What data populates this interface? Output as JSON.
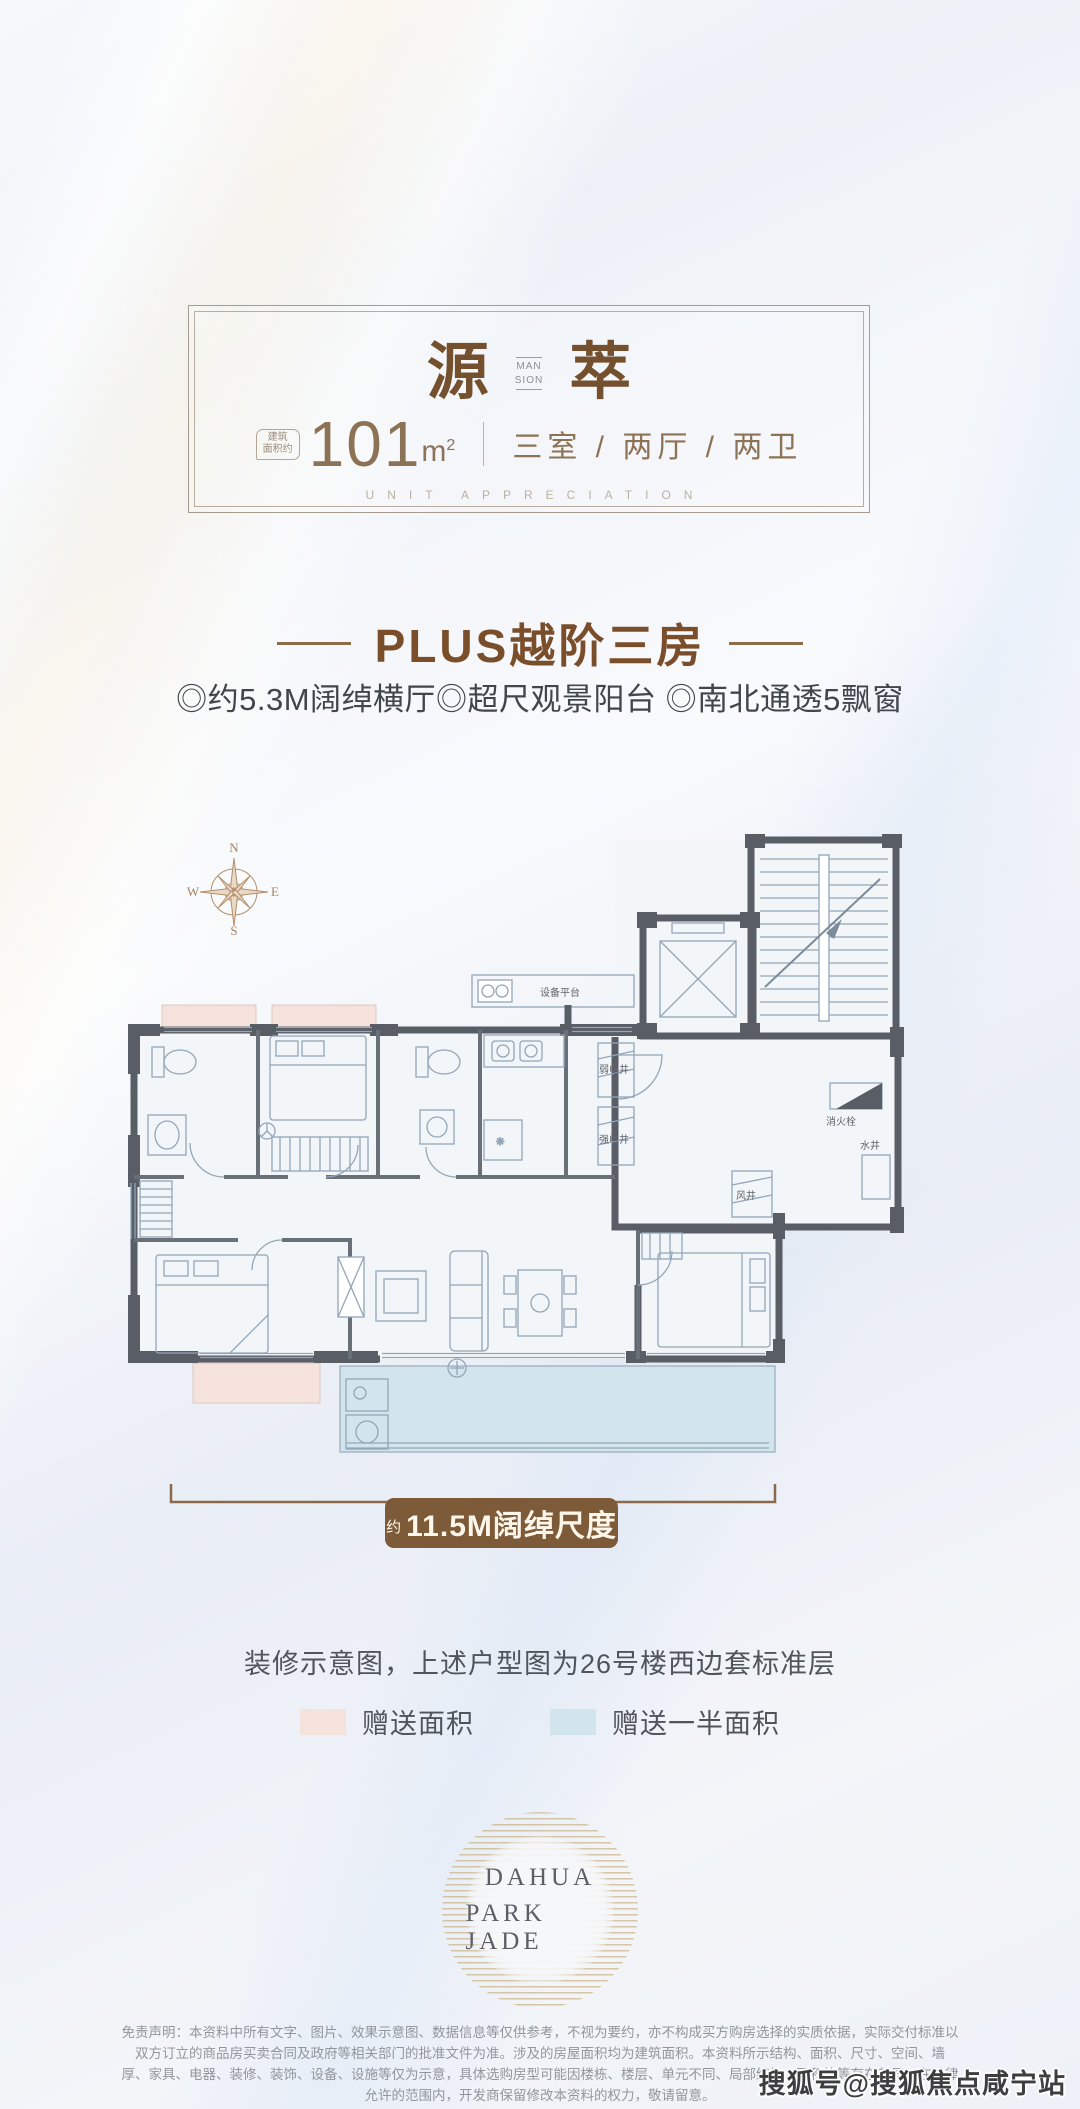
{
  "header_card": {
    "brand_first": "源",
    "brand_second": "萃",
    "brand_mid_top": "MAN",
    "brand_mid_bottom": "SION",
    "area_note_line1": "建筑",
    "area_note_line2": "面积约",
    "area_value": "101",
    "area_unit_base": "m",
    "area_unit_sup": "2",
    "rooms": "三室 / 两厅 / 两卫",
    "tagline": "UNIT APPRECIATION"
  },
  "headline": {
    "title": "PLUS越阶三房",
    "features": "◎约5.3M阔绰横厅◎超尺观景阳台 ◎南北通透5飘窗"
  },
  "compass": {
    "north": "N",
    "south": "S",
    "east": "E",
    "west": "W"
  },
  "floorplan": {
    "labels": {
      "equipment_platform": "设备平台",
      "weak_electric_shaft": "弱电井",
      "strong_electric_shaft": "强电井",
      "fire_hydrant": "消火栓",
      "water_shaft": "水井",
      "air_shaft": "风井"
    },
    "colors": {
      "wall": "#585d66",
      "furniture_line": "#92a6b8",
      "gift_area": "#f6e2dd",
      "half_gift_area": "#d3e5ec"
    }
  },
  "dimension": {
    "prefix": "约",
    "label": "11.5M阔绰尺度",
    "badge_color": "#7d5a38"
  },
  "caption": "装修示意图，上述户型图为26号楼西边套标准层",
  "legend": {
    "items": [
      {
        "label": "赠送面积",
        "color": "#f6e2dd"
      },
      {
        "label": "赠送一半面积",
        "color": "#d3e5ec"
      }
    ]
  },
  "logo": {
    "line1": "DAHUA",
    "line2": "PARK JADE"
  },
  "disclaimer": {
    "line1": "免责声明：本资料中所有文字、图片、效果示意图、数据信息等仅供参考，不视为要约，亦不构成买方购房选择的实质依据，实际交付标准以双方订立的商品房买卖合同及政府等相关部门的批准文件为准。涉及的房屋面积均为建筑面积。本资料所示结构、面积、尺寸、空间、墙",
    "line2": "厚、家具、电器、装修、装饰、设备、设施等仅为示意，具体选购房型可能因楼栋、楼层、单元不同、局部结构、面积等等存在差异，在法律允许的范围内，开发商保留修改本资料的权力，敬请留意。"
  },
  "watermark": {
    "text": "搜狐号@搜狐焦点咸宁站"
  }
}
